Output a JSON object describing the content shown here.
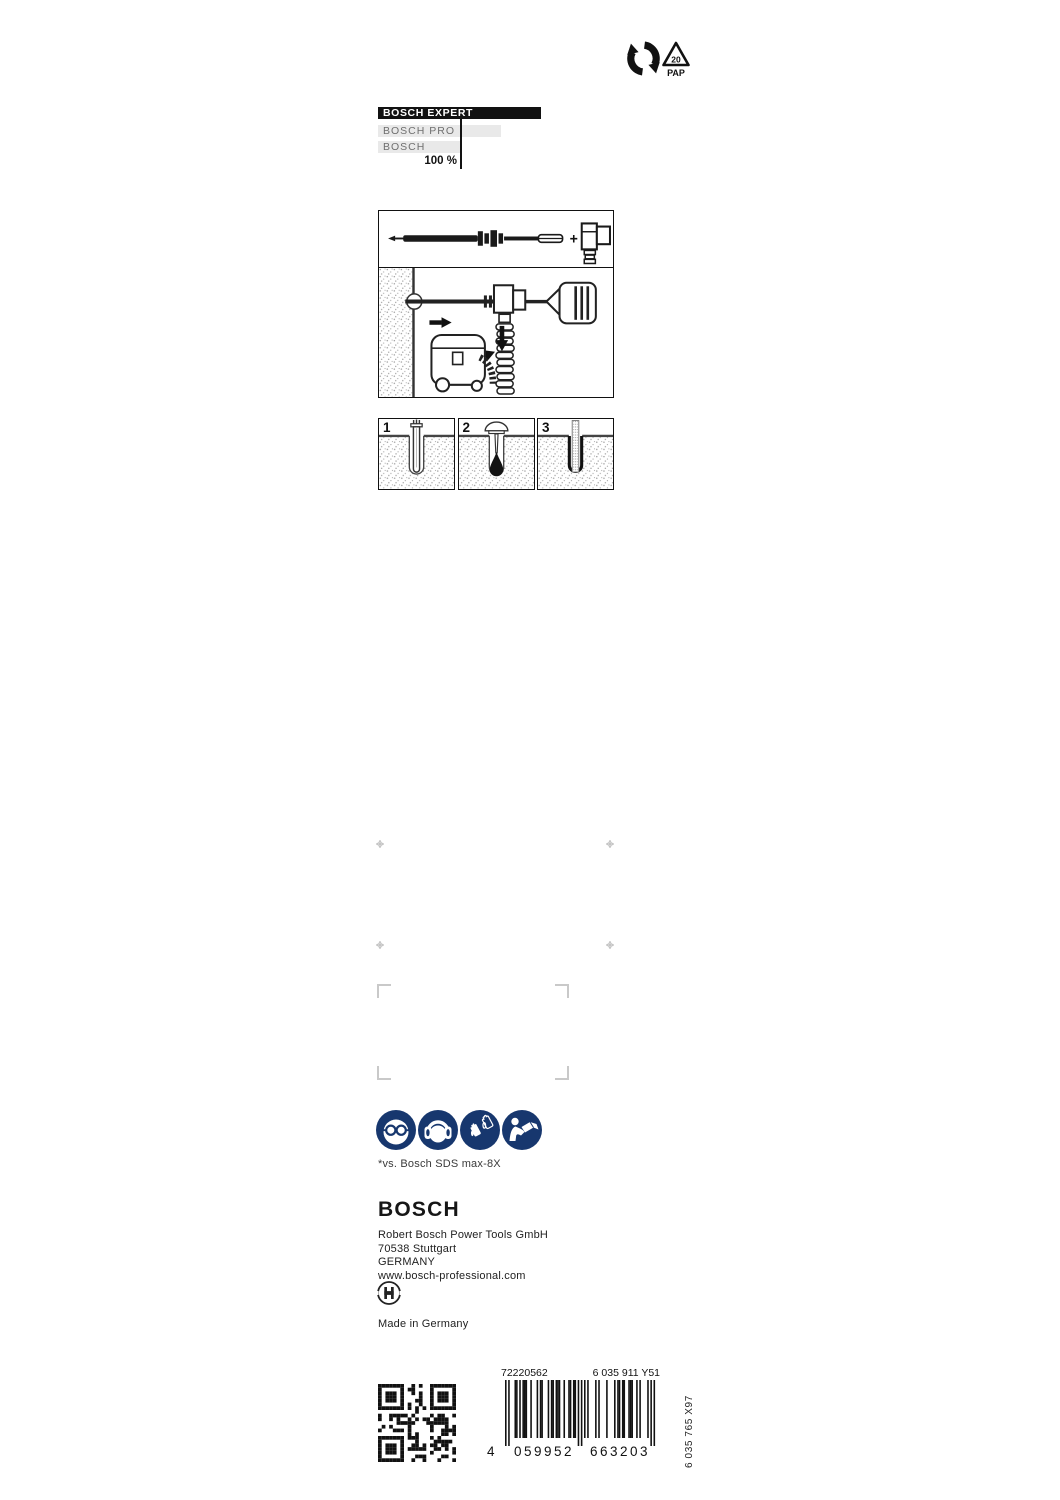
{
  "recycling": {
    "pap_code": "20",
    "pap_label": "PAP"
  },
  "comparison_chart": {
    "type": "bar",
    "bars": [
      {
        "label": "BOSCH EXPERT",
        "variant": "expert",
        "bar_px": 163,
        "relative_pct_estimate": 199
      },
      {
        "label": "BOSCH PRO",
        "variant": "pro",
        "bar_px": 123,
        "relative_pct_estimate": 150
      },
      {
        "label": "BOSCH",
        "variant": "standard",
        "bar_px": 82,
        "relative_pct_estimate": 100
      }
    ],
    "baseline_label": "100 %",
    "baseline_px": 82
  },
  "instructions": {
    "assembly_plus": "+",
    "step_labels": [
      "1",
      "2",
      "3"
    ]
  },
  "safety_icons": [
    {
      "name": "wear-eye-protection"
    },
    {
      "name": "wear-ear-protection"
    },
    {
      "name": "wear-protective-gloves"
    },
    {
      "name": "read-instruction-manual"
    }
  ],
  "footnote": "*vs. Bosch SDS max-8X",
  "manufacturer": {
    "logo": "BOSCH",
    "name": "Robert Bosch Power Tools GmbH",
    "city": "70538 Stuttgart",
    "country": "GERMANY",
    "website": "www.bosch-professional.com",
    "origin": "Made in Germany"
  },
  "codes": {
    "order_number": "72220562",
    "type_code": "6 035 911 Y51",
    "ean": "4059952663203",
    "ean_groups": [
      "4",
      "059952",
      "663203"
    ],
    "side_code": "6 035 765 X97"
  },
  "colors": {
    "safety_blue": "#17376e",
    "bar_black": "#121212",
    "bar_gray": "#e9e9e9"
  }
}
